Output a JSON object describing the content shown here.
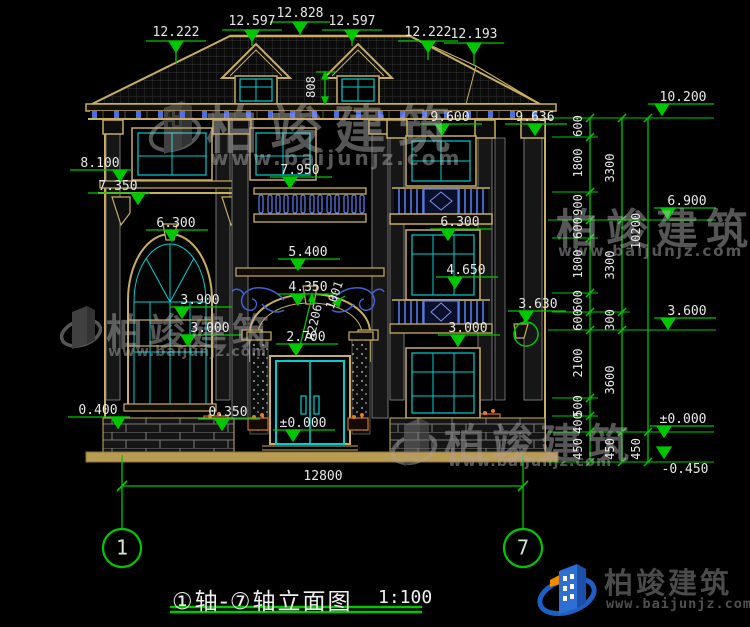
{
  "watermark": {
    "brand": "柏竣建筑",
    "url": "www.baijunjz.com"
  },
  "logo": {
    "brand": "柏竣建筑",
    "url": "www.baijunjz.com"
  },
  "title": {
    "name": "①轴-⑦轴立面图",
    "scale": "1:100"
  },
  "axis_bubbles": {
    "left": "1",
    "right": "7"
  },
  "dims": {
    "top": [
      "12.222",
      "12.597",
      "12.828",
      "12.597",
      "12.222",
      "12.193"
    ],
    "roof_height": "808",
    "left": [
      "8.100",
      "7.350",
      "6.300",
      "3.900",
      "3.000",
      "0.400",
      "0.350"
    ],
    "center": [
      "7.950",
      "5.400",
      "4.350",
      "2.700",
      "±0.000"
    ],
    "arc": {
      "radius": "R2206",
      "note": "1001"
    },
    "right_wall": [
      "9.600",
      "9.636",
      "6.300",
      "4.650",
      "3.000",
      "3.630"
    ],
    "chain_inner": [
      "600",
      "1800",
      "900",
      "600",
      "1800",
      "600",
      "600",
      "2100",
      "500",
      "400",
      "450"
    ],
    "chain_mid": [
      "3300",
      "3300",
      "300",
      "3600",
      "450"
    ],
    "chain_outer": [
      "10200",
      "450"
    ],
    "right_levels": [
      "10.200",
      "6.900",
      "3.600",
      "±0.000",
      "-0.450"
    ],
    "overall_width": "12800"
  },
  "colors": {
    "dimension_green": "#00c800",
    "line_tan": "#c9ae62",
    "glazing_cyan": "#00cfcf",
    "ornament_blue": "#4a6fe3",
    "logo_blue": "#2e6fd6",
    "logo_orange": "#f08a00"
  }
}
